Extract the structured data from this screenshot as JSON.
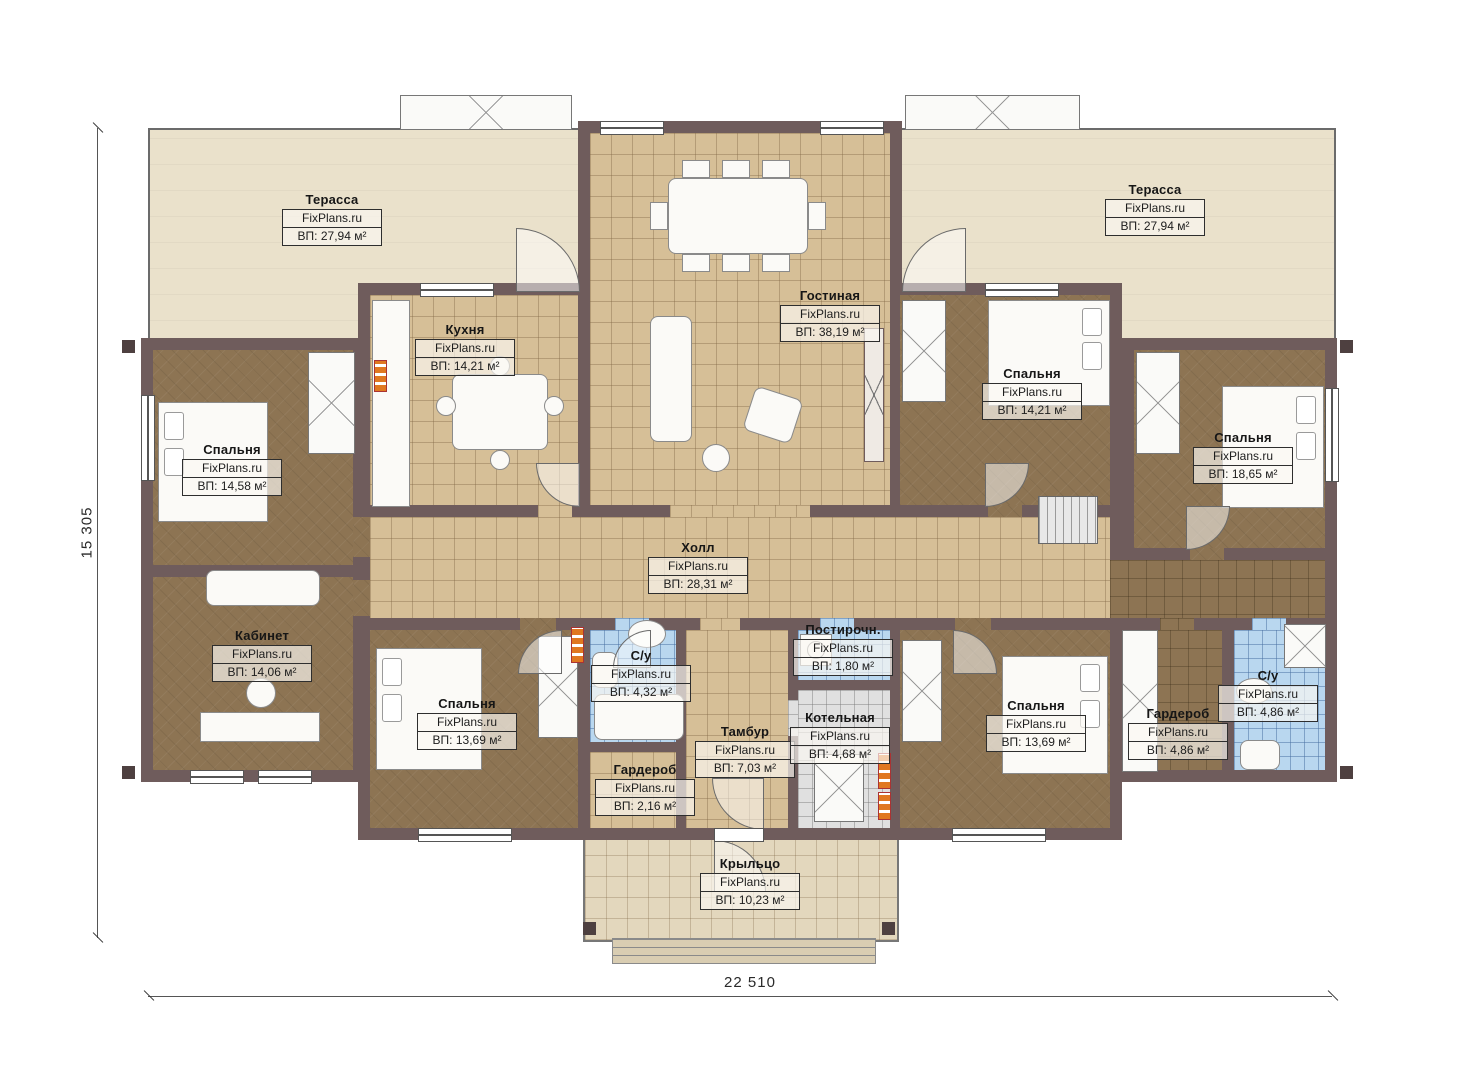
{
  "plan": {
    "brand": "FixPlans.ru",
    "dimensions": {
      "width_mm": "22 510",
      "height_mm": "15 305"
    },
    "rooms": [
      {
        "id": "terrace-left",
        "name": "Терасса",
        "brand": "FixPlans.ru",
        "area": "ВП: 27,94 м²"
      },
      {
        "id": "terrace-right",
        "name": "Терасса",
        "brand": "FixPlans.ru",
        "area": "ВП: 27,94 м²"
      },
      {
        "id": "kitchen",
        "name": "Кухня",
        "brand": "FixPlans.ru",
        "area": "ВП: 14,21 м²"
      },
      {
        "id": "living-room",
        "name": "Гостиная",
        "brand": "FixPlans.ru",
        "area": "ВП: 38,19 м²"
      },
      {
        "id": "bedroom-left",
        "name": "Спальня",
        "brand": "FixPlans.ru",
        "area": "ВП: 14,58 м²"
      },
      {
        "id": "bedroom-top-right",
        "name": "Спальня",
        "brand": "FixPlans.ru",
        "area": "ВП: 14,21 м²"
      },
      {
        "id": "bedroom-far-right",
        "name": "Спальня",
        "brand": "FixPlans.ru",
        "area": "ВП: 18,65 м²"
      },
      {
        "id": "hall",
        "name": "Холл",
        "brand": "FixPlans.ru",
        "area": "ВП: 28,31 м²"
      },
      {
        "id": "office",
        "name": "Кабинет",
        "brand": "FixPlans.ru",
        "area": "ВП: 14,06 м²"
      },
      {
        "id": "bathroom-left",
        "name": "С/у",
        "brand": "FixPlans.ru",
        "area": "ВП: 4,32 м²"
      },
      {
        "id": "laundry",
        "name": "Постирочн.",
        "brand": "FixPlans.ru",
        "area": "ВП: 1,80 м²"
      },
      {
        "id": "bedroom-bottom-left",
        "name": "Спальня",
        "brand": "FixPlans.ru",
        "area": "ВП: 13,69 м²"
      },
      {
        "id": "vestibule",
        "name": "Тамбур",
        "brand": "FixPlans.ru",
        "area": "ВП: 7,03 м²"
      },
      {
        "id": "boiler-room",
        "name": "Котельная",
        "brand": "FixPlans.ru",
        "area": "ВП: 4,68 м²"
      },
      {
        "id": "wardrobe-bottom",
        "name": "Гардероб",
        "brand": "FixPlans.ru",
        "area": "ВП: 2,16 м²"
      },
      {
        "id": "bedroom-bottom-right",
        "name": "Спальня",
        "brand": "FixPlans.ru",
        "area": "ВП: 13,69 м²"
      },
      {
        "id": "wardrobe-right",
        "name": "Гардероб",
        "brand": "FixPlans.ru",
        "area": "ВП: 4,86 м²"
      },
      {
        "id": "bathroom-right",
        "name": "С/у",
        "brand": "FixPlans.ru",
        "area": "ВП: 4,86 м²"
      },
      {
        "id": "porch",
        "name": "Крыльцо",
        "brand": "FixPlans.ru",
        "area": "ВП: 10,23 м²"
      }
    ]
  }
}
